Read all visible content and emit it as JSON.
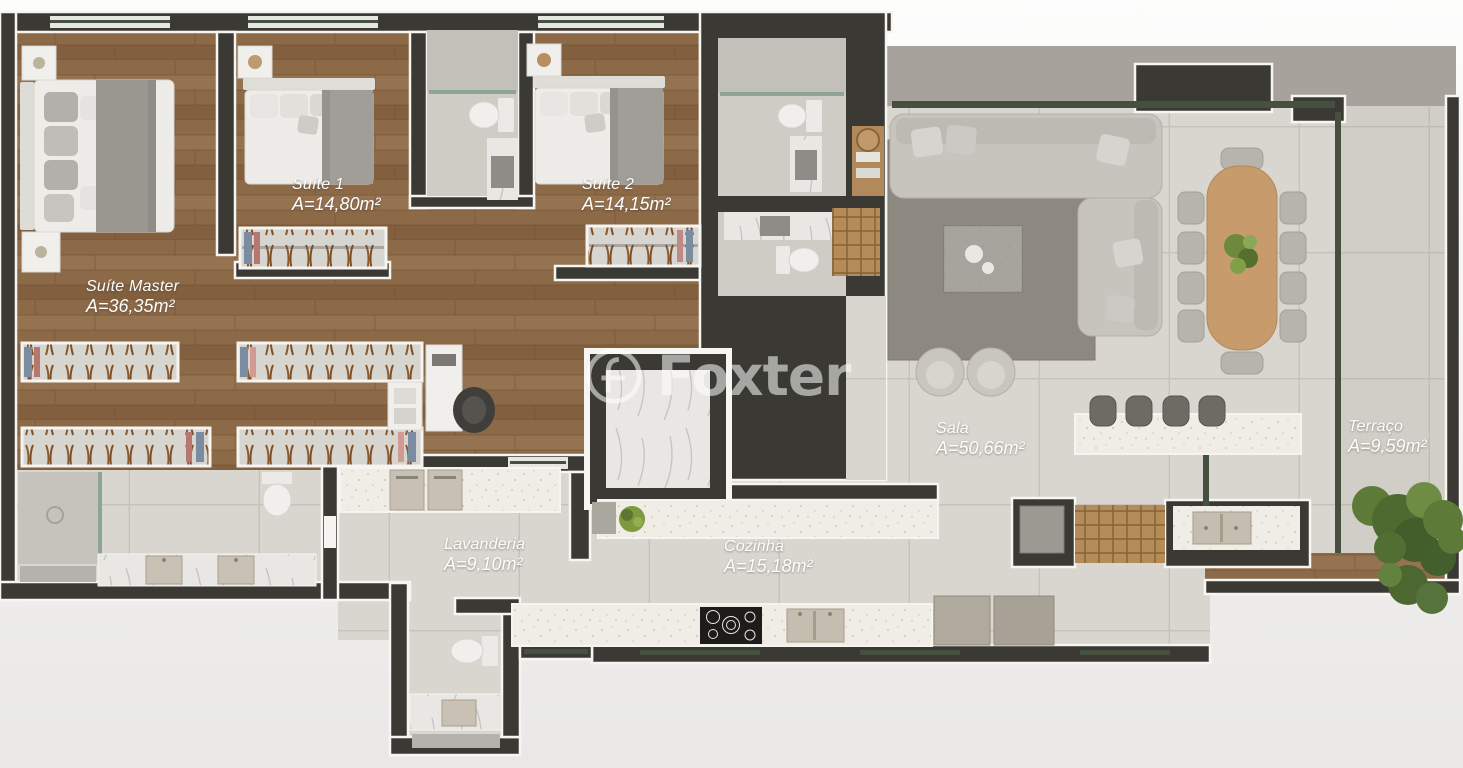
{
  "plan": {
    "watermark": "Foxter",
    "rooms": [
      {
        "name": "Suíte Master",
        "area": "A=36,35m²"
      },
      {
        "name": "Suíte 1",
        "area": "A=14,80m²"
      },
      {
        "name": "Suíte 2",
        "area": "A=14,15m²"
      },
      {
        "name": "Sala",
        "area": "A=50,66m²"
      },
      {
        "name": "Lavanderia",
        "area": "A=9,10m²"
      },
      {
        "name": "Cozinha",
        "area": "A=15,18m²"
      },
      {
        "name": "Terraço",
        "area": "A=9,59m²"
      }
    ],
    "palette": {
      "wall": "#3b3934",
      "wall_lining": "#f6f5f1",
      "wood_floor": "#8c6947",
      "tile_floor": "#d9d6d0",
      "bath_tile": "#cfccc6",
      "counter_speckle": "#efede6",
      "glass": "#46503f",
      "concrete_slab": "#a7a39c",
      "rug": "#8d8880",
      "sofa": "#c7c4be",
      "dining_wood": "#c79b6b",
      "plant_green": "#5d7a39",
      "label_text": "#fdfdfc"
    }
  }
}
